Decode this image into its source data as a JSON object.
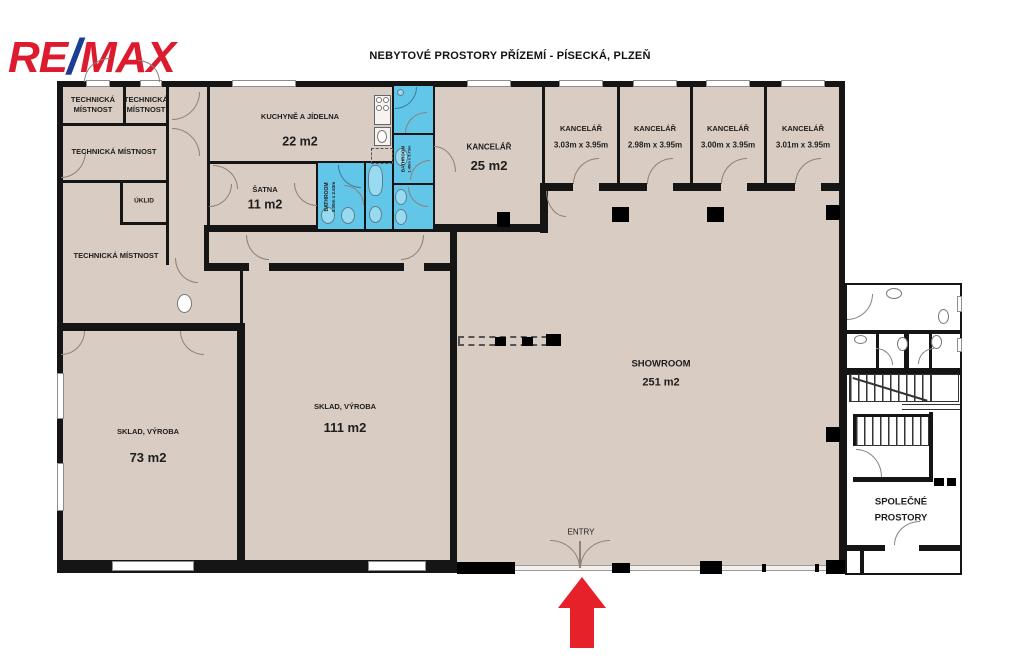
{
  "title": "NEBYTOVÉ PROSTORY PŘÍZEMÍ - PÍSECKÁ, PLZEŇ",
  "logo": {
    "re": "RE",
    "slash": "/",
    "max": "MAX"
  },
  "colors": {
    "room_fill": "#d9ccc2",
    "bathroom_fill": "#62c6e9",
    "wall": "#151515",
    "logo_red": "#dc1c2e",
    "logo_blue": "#1b3e94",
    "arrow_red": "#e62129"
  },
  "rooms": {
    "tech_a": {
      "line1": "TECHNICKÁ",
      "line2": "MÍSTNOST"
    },
    "tech_b": {
      "line1": "TECHNICKÁ",
      "line2": "MÍSTNOST"
    },
    "tech_c": {
      "name": "TECHNICKÁ MÍSTNOST"
    },
    "uklid": {
      "name": "ÚKLID"
    },
    "tech_d": {
      "name": "TECHNICKÁ MÍSTNOST"
    },
    "kitchen": {
      "name": "KUCHYNĚ A JÍDELNA",
      "area": "22 m2"
    },
    "satna": {
      "name": "ŠATNA",
      "area": "11 m2"
    },
    "bathroom_1": {
      "name": "BATHROOM",
      "dims": "3.00m x 2.63m"
    },
    "bathroom_2": {
      "name": "BATHROOM",
      "dims": "1.45m x 5.73m"
    },
    "office_main": {
      "name": "KANCELÁŘ",
      "area": "25 m2"
    },
    "office_1": {
      "name": "KANCELÁŘ",
      "dims": "3.03m x 3.95m"
    },
    "office_2": {
      "name": "KANCELÁŘ",
      "dims": "2.98m x 3.95m"
    },
    "office_3": {
      "name": "KANCELÁŘ",
      "dims": "3.00m x 3.95m"
    },
    "office_4": {
      "name": "KANCELÁŘ",
      "dims": "3.01m x 3.95m"
    },
    "sklad_73": {
      "name": "SKLAD, VÝROBA",
      "area": "73 m2"
    },
    "sklad_111": {
      "name": "SKLAD, VÝROBA",
      "area": "111 m2"
    },
    "showroom": {
      "name": "SHOWROOM",
      "area": "251 m2"
    },
    "common": {
      "line1": "SPOLEČNÉ",
      "line2": "PROSTORY"
    },
    "entry": {
      "label": "ENTRY"
    }
  }
}
